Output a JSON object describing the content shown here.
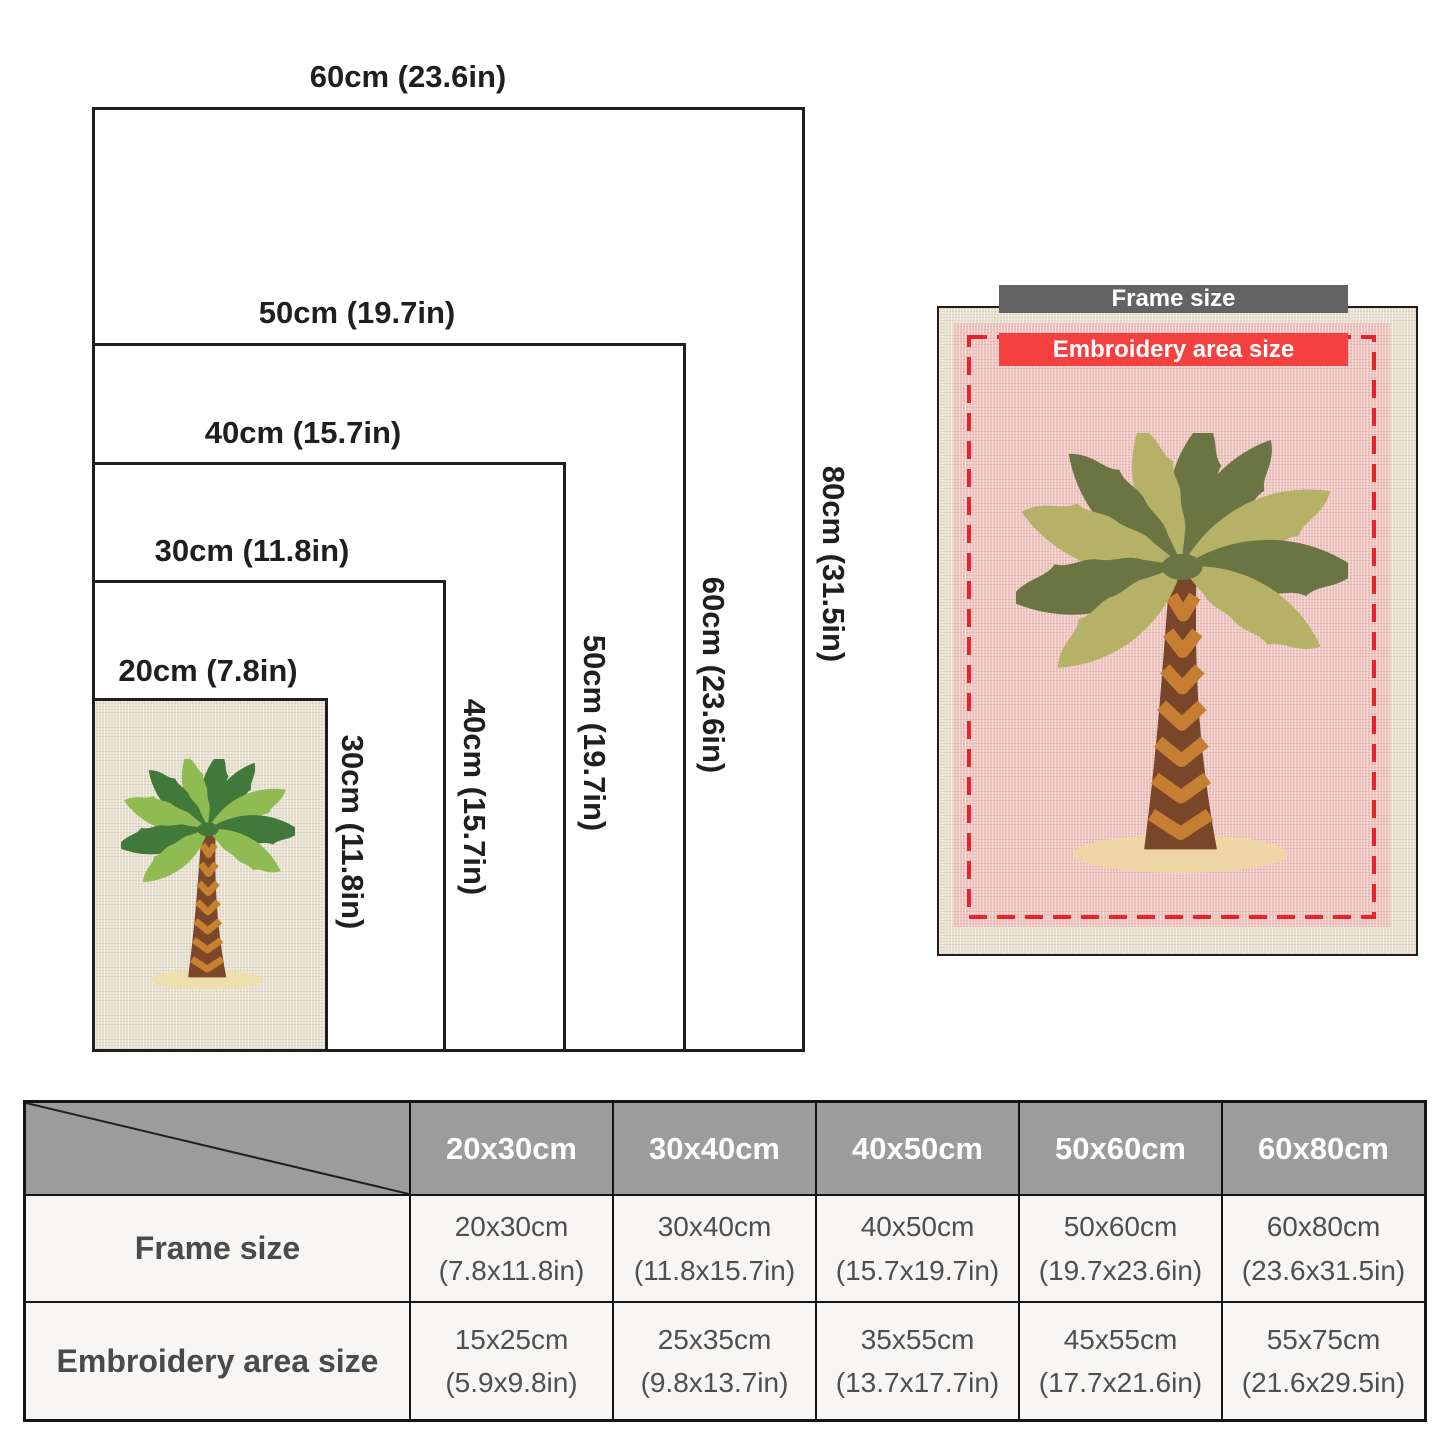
{
  "diagram": {
    "frames": [
      {
        "name": "60x80cm frame",
        "width_label": "60cm (23.6in)",
        "height_label": "80cm (31.5in)"
      },
      {
        "name": "50x60cm frame",
        "width_label": "50cm (19.7in)",
        "height_label": "60cm (23.6in)"
      },
      {
        "name": "40x50cm frame",
        "width_label": "40cm (15.7in)",
        "height_label": "50cm (19.7in)"
      },
      {
        "name": "30x40cm frame",
        "width_label": "30cm (11.8in)",
        "height_label": "40cm (15.7in)"
      },
      {
        "name": "20x30cm frame",
        "width_label": "20cm (7.8in)",
        "height_label": "30cm (11.8in)"
      }
    ]
  },
  "photo": {
    "frame_badge": "Frame size",
    "area_badge": "Embroidery area size"
  },
  "table": {
    "columns": [
      "20x30cm",
      "30x40cm",
      "40x50cm",
      "50x60cm",
      "60x80cm"
    ],
    "rows": [
      {
        "label": "Frame size",
        "cells": [
          [
            "20x30cm",
            "(7.8x11.8in)"
          ],
          [
            "30x40cm",
            "(11.8x15.7in)"
          ],
          [
            "40x50cm",
            "(15.7x19.7in)"
          ],
          [
            "50x60cm",
            "(19.7x23.6in)"
          ],
          [
            "60x80cm",
            "(23.6x31.5in)"
          ]
        ]
      },
      {
        "label": "Embroidery area size",
        "cells": [
          [
            "15x25cm",
            "(5.9x9.8in)"
          ],
          [
            "25x35cm",
            "(9.8x13.7in)"
          ],
          [
            "35x55cm",
            "(13.7x17.7in)"
          ],
          [
            "45x55cm",
            "(17.7x21.6in)"
          ],
          [
            "55x75cm",
            "(21.6x29.5in)"
          ]
        ]
      }
    ]
  },
  "colors": {
    "line": "#1f1f1f",
    "cream_fabric": "#e8e1d1",
    "pink_fabric": "#eec5c1",
    "dash_red": "#e8232a",
    "badge_red": "#f4403f",
    "badge_gray": "#636363",
    "table_header_bg": "#9c9c9c",
    "table_cell_bg": "#f7f6f5",
    "palm": {
      "left": {
        "dark": "#41793a",
        "light": "#8fbb52",
        "trunk": "#7c482a",
        "chev": "#c6802f",
        "sand": "#eddfae"
      },
      "right": {
        "dark": "#6b7544",
        "light": "#b5b166",
        "trunk": "#7a462a",
        "chev": "#c67e33",
        "sand": "#f0d6a6"
      }
    }
  }
}
